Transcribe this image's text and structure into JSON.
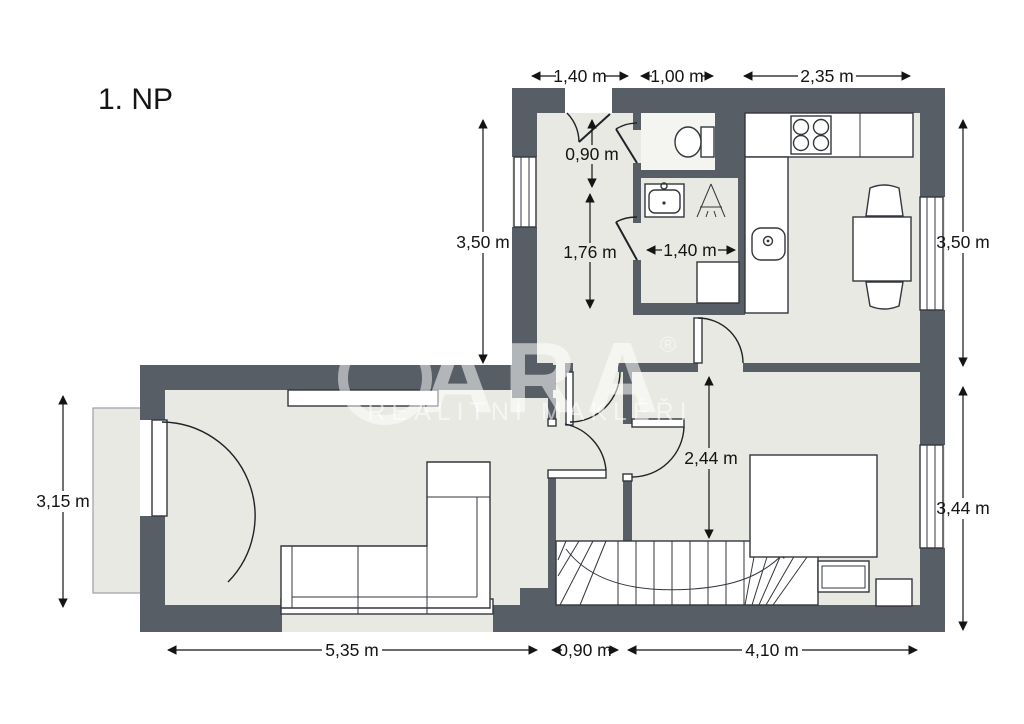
{
  "title": "1. NP",
  "watermark": {
    "letters": "ARA",
    "registered": "®",
    "tagline": "REALITNÍ MAKLÉŘI"
  },
  "dimensions": {
    "top_entry": "1,40 m",
    "top_wc": "1,00 m",
    "top_kitchen": "2,35 m",
    "left_upper": "3,50 m",
    "right_kitchen": "3,50 m",
    "entry_depth": "0,90 m",
    "hall_length": "1,76 m",
    "bath_width": "1,40 m",
    "left_living": "3,15 m",
    "hall_height": "2,44 m",
    "right_bedroom": "3,44 m",
    "bottom_living": "5,35 m",
    "bottom_hall": "0,90 m",
    "bottom_bedroom": "4,10 m"
  },
  "colors": {
    "wall": "#585e65",
    "floor": "#e9e9e3",
    "wc_floor": "#f4f5f1",
    "outline": "#33373c",
    "dim_text": "#141414",
    "watermark": "rgba(255,255,255,0.55)"
  }
}
